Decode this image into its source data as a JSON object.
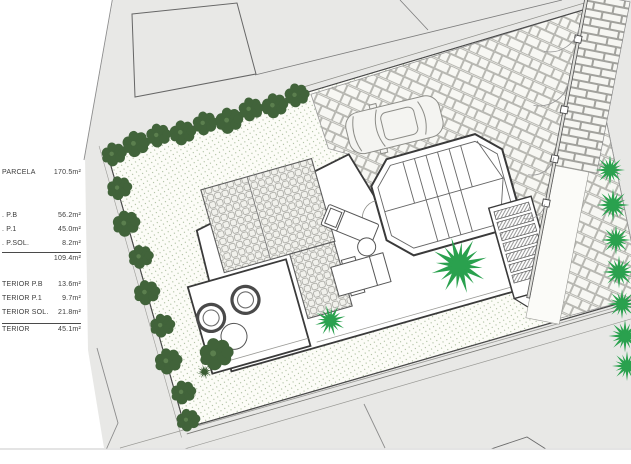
{
  "area_table": {
    "rows": [
      {
        "label": "PARCELA",
        "value": "170.5m²"
      },
      {
        "label": ".  P.B",
        "value": "56.2m²"
      },
      {
        "label": ".  P.1",
        "value": "45.0m²"
      },
      {
        "label": ".  P.SOL.",
        "value": "8.2m²"
      },
      {
        "label": "",
        "value": "109.4m²"
      },
      {
        "label": "TERIOR  P.B",
        "value": "13.6m²"
      },
      {
        "label": "TERIOR  P.1",
        "value": "9.7m²"
      },
      {
        "label": "TERIOR  SOL.",
        "value": "21.8m²"
      },
      {
        "label": "TERIOR",
        "value": "45.1m²"
      }
    ]
  },
  "colors": {
    "street-gray": "#e8e8e6",
    "lawn-bg": "#fcfcf7",
    "lawn-dot": "#a3b896",
    "hedge-green": "#41633a",
    "palm-green": "#2aa14e",
    "line-dark": "#4a4a4a",
    "line-mid": "#8a8a86",
    "paving-fill": "#f7f7f3"
  }
}
